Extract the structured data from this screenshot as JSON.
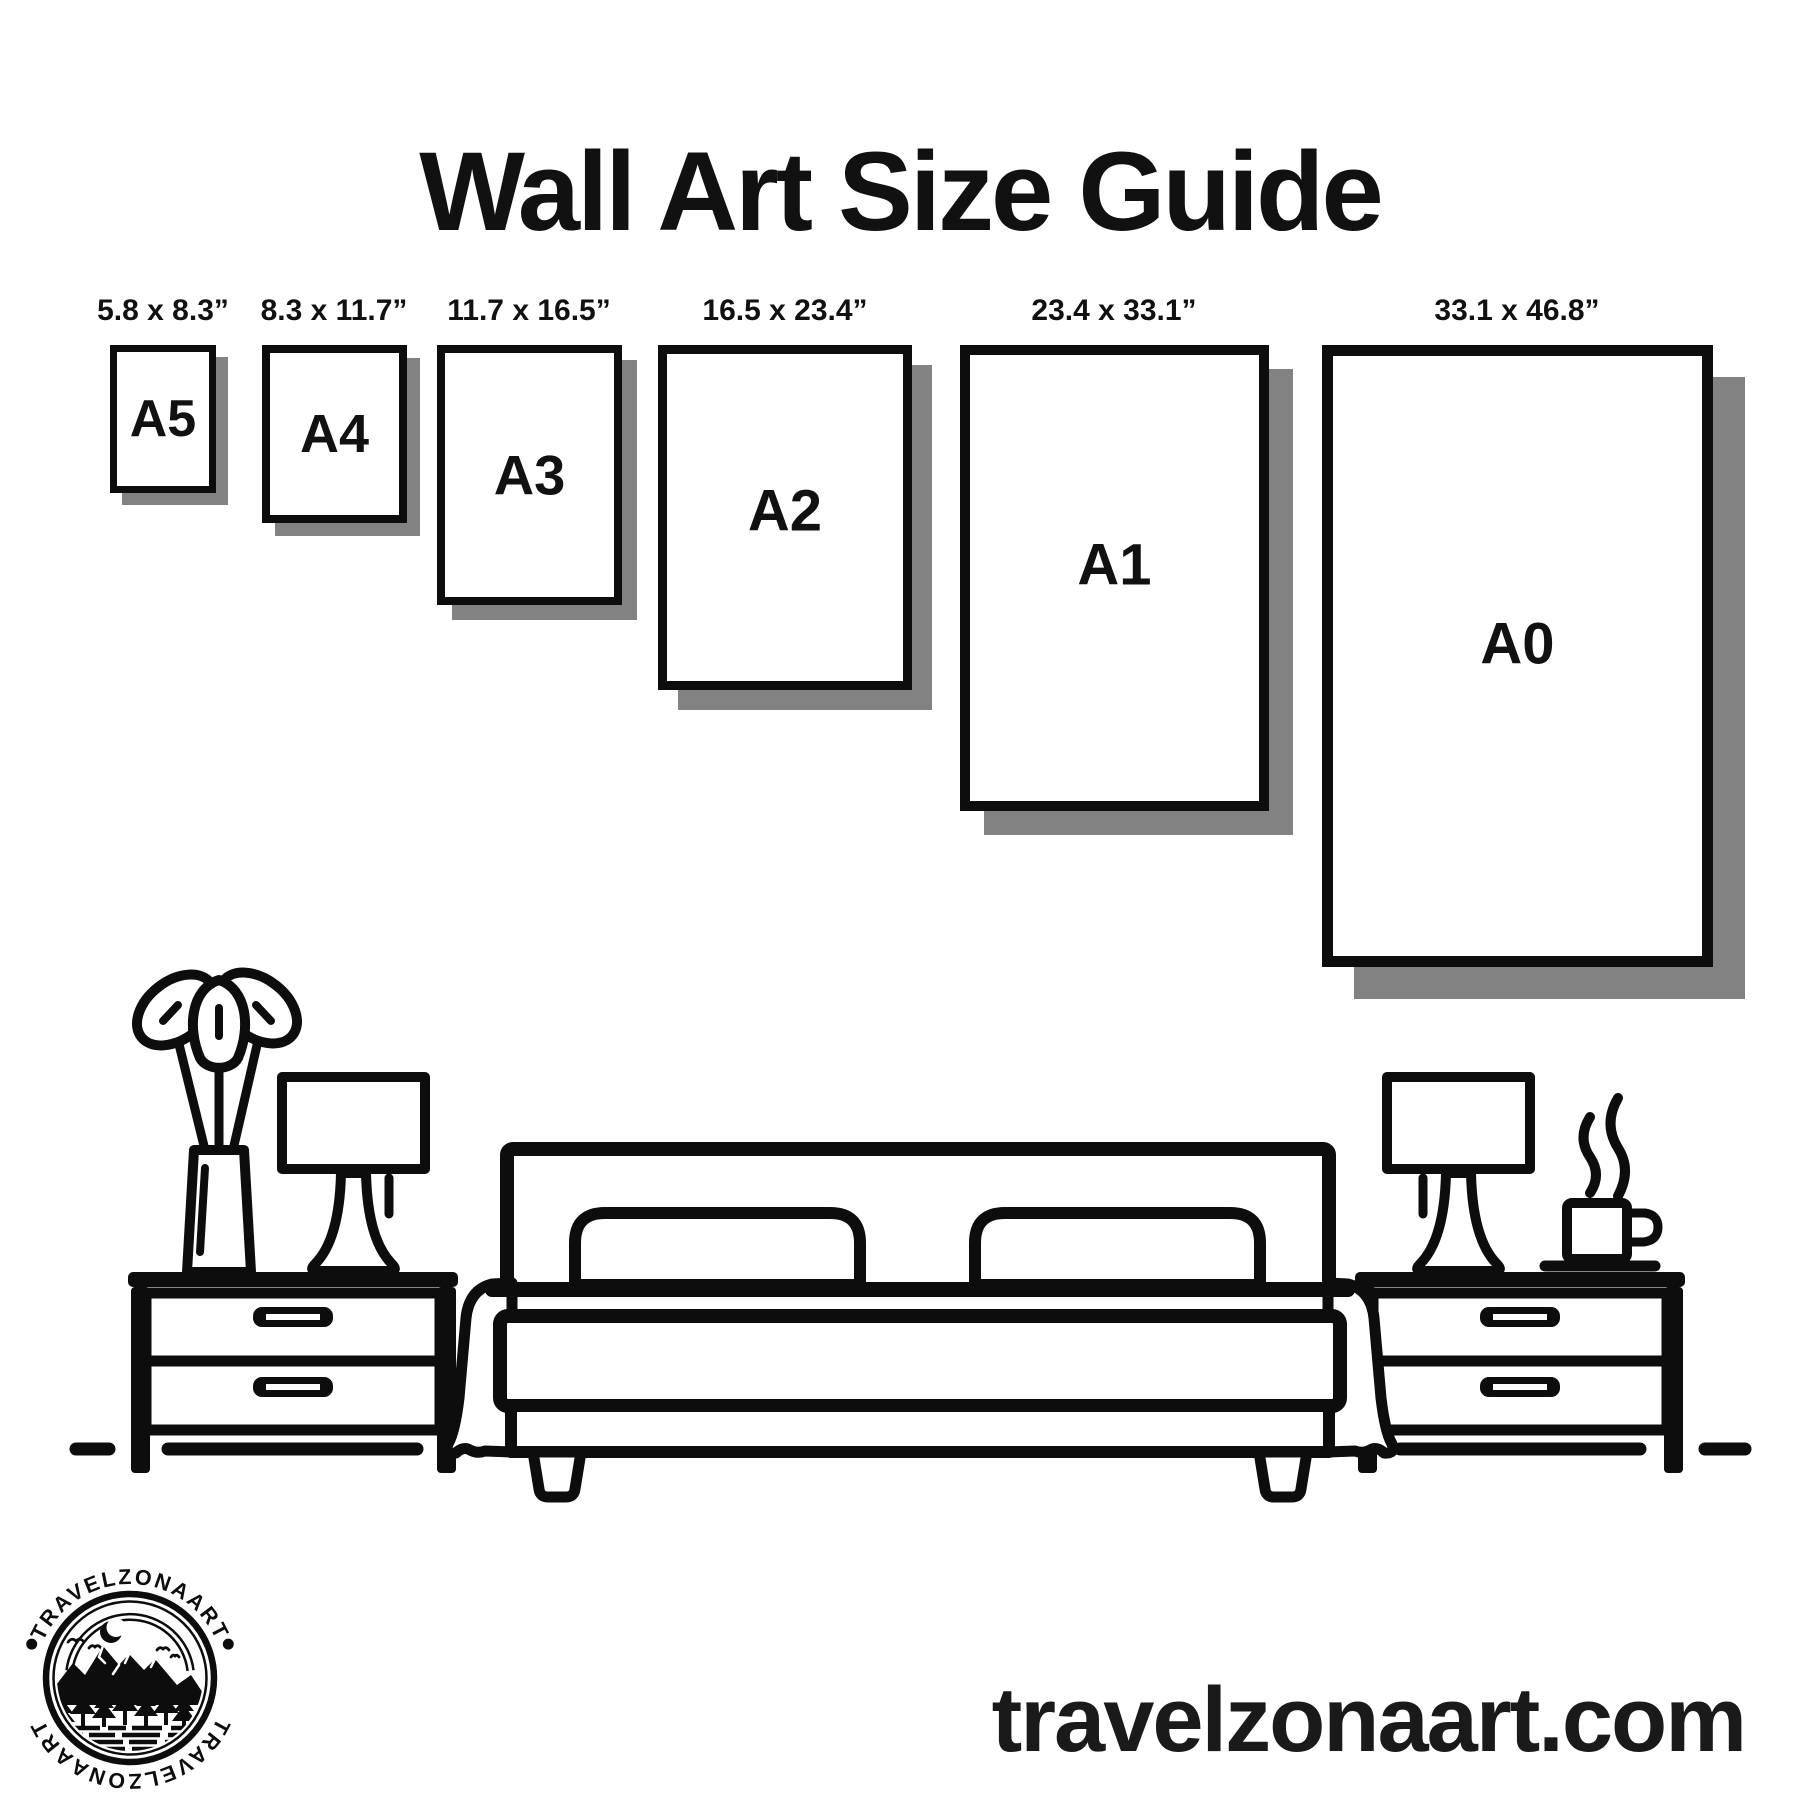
{
  "page": {
    "title": "Wall Art Size Guide"
  },
  "sizes": [
    {
      "code": "A5",
      "dimensions": "5.8 x 8.3”"
    },
    {
      "code": "A4",
      "dimensions": "8.3 x 11.7”"
    },
    {
      "code": "A3",
      "dimensions": "11.7 x 16.5”"
    },
    {
      "code": "A2",
      "dimensions": "16.5 x 23.4”"
    },
    {
      "code": "A1",
      "dimensions": "23.4 x 33.1”"
    },
    {
      "code": "A0",
      "dimensions": "33.1 x 46.8”"
    }
  ],
  "logo": {
    "brand_top": "TRAVELZONAART",
    "brand_bottom": "TRAVELZONAART",
    "separator": "•"
  },
  "footer": {
    "website": "travelzonaart.com"
  },
  "colors": {
    "ink": "#0d0d0d",
    "shadow": "#828282",
    "background": "#ffffff"
  }
}
